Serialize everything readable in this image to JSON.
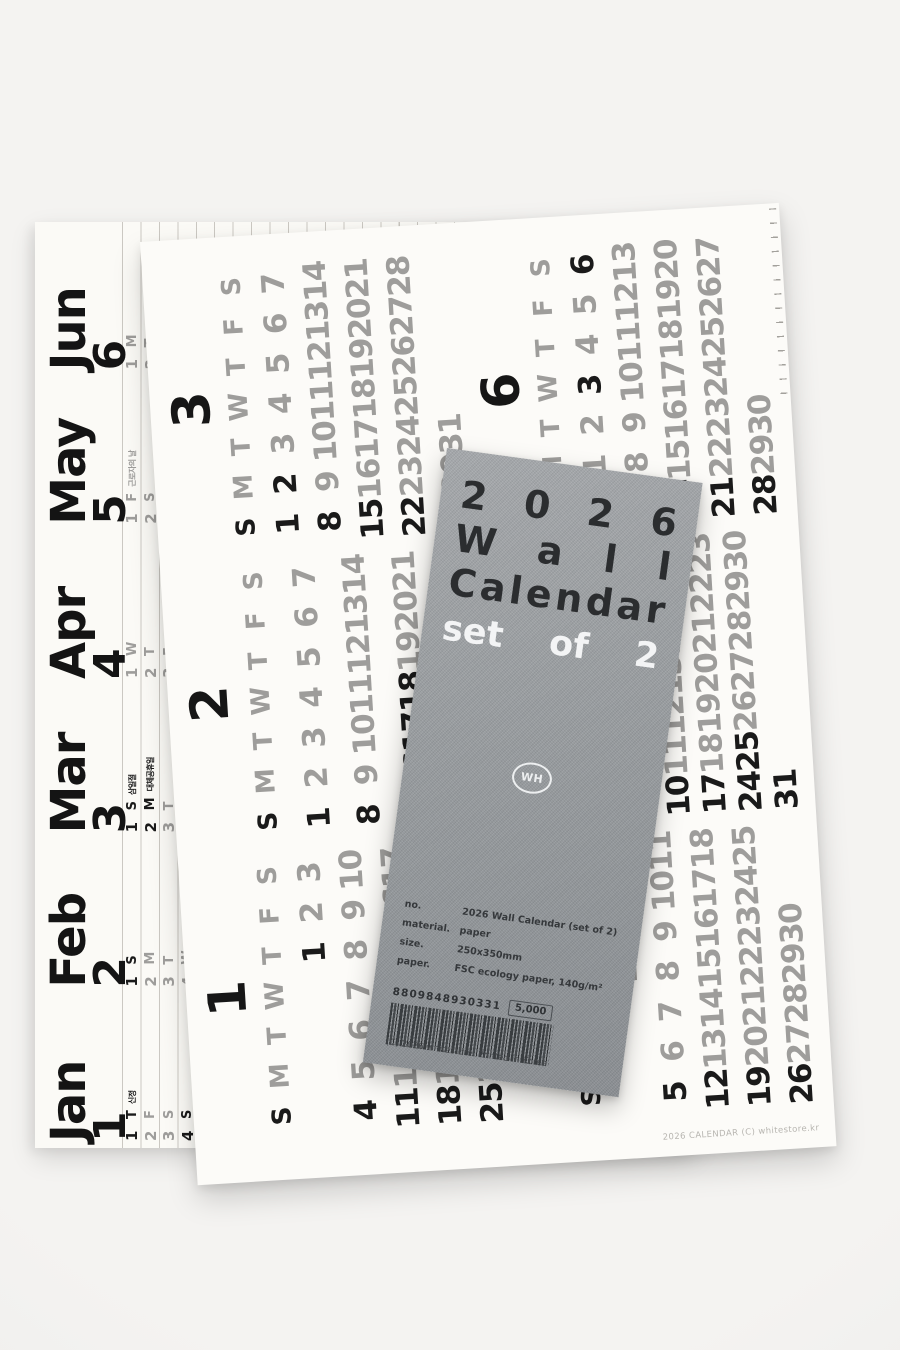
{
  "colors": {
    "backdrop": "#f1f0ee",
    "paper": "#fcfbf8",
    "ink_black": "#1a1a1a",
    "ink_gray": "#9e9d9b",
    "card_gray": "#989c9f"
  },
  "weekday_letters": [
    "S",
    "M",
    "T",
    "W",
    "T",
    "F",
    "S"
  ],
  "months": [
    {
      "name": "Jan",
      "num": "1",
      "days": 31,
      "first_dow": 4,
      "black": [
        1,
        4,
        11,
        18,
        25
      ],
      "notes": {
        "1": "신정"
      }
    },
    {
      "name": "Feb",
      "num": "2",
      "days": 28,
      "first_dow": 0,
      "black": [
        1,
        8,
        15,
        16,
        17,
        18,
        22
      ],
      "notes": {}
    },
    {
      "name": "Mar",
      "num": "3",
      "days": 31,
      "first_dow": 0,
      "black": [
        1,
        2,
        8,
        15,
        22,
        29
      ],
      "notes": {
        "1": "삼일절",
        "2": "대체공휴일"
      }
    },
    {
      "name": "Apr",
      "num": "4",
      "days": 30,
      "first_dow": 3,
      "black": [
        5,
        12,
        19,
        26
      ],
      "notes": {}
    },
    {
      "name": "May",
      "num": "5",
      "days": 31,
      "first_dow": 5,
      "black": [
        3,
        10,
        17,
        24,
        25,
        31
      ],
      "notes": {
        "1": "근로자의 날"
      }
    },
    {
      "name": "Jun",
      "num": "6",
      "days": 30,
      "first_dow": 1,
      "black": [
        3,
        6,
        7,
        14,
        21,
        28
      ],
      "notes": {}
    }
  ],
  "grid_sheet": {
    "caption": "2026 CALENDAR (C) whitestore.kr"
  },
  "card": {
    "title_lines": [
      {
        "text": "2026",
        "mode": "chars",
        "color": "dark"
      },
      {
        "text": "Wall",
        "mode": "chars",
        "color": "dark"
      },
      {
        "text": "Calendar",
        "mode": "chars",
        "color": "dark"
      },
      {
        "text": "set of 2",
        "mode": "words",
        "color": "white"
      }
    ],
    "logo": "WH",
    "specs": [
      {
        "label": "no.",
        "value": "2026 Wall Calendar (set of 2)"
      },
      {
        "label": "material.",
        "value": "paper"
      },
      {
        "label": "size.",
        "value": "250x350mm"
      },
      {
        "label": "paper.",
        "value": "FSC ecology paper, 140g/m²"
      }
    ],
    "barcode_number": "8809848930331",
    "price": "5,000",
    "copyright": "(C) 2026 whitestore. Printed in Korea"
  }
}
